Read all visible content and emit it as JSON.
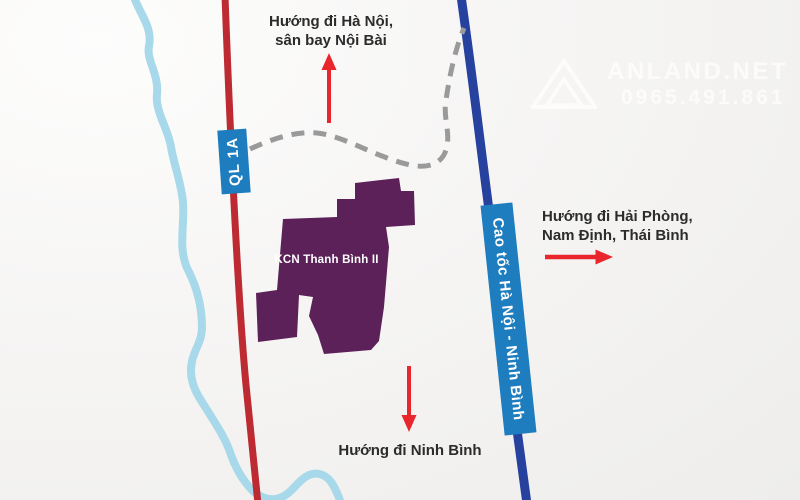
{
  "map": {
    "direction_labels": {
      "north": {
        "line1": "Hướng đi Hà Nội,",
        "line2": "sân bay Nội Bài"
      },
      "east": {
        "line1": "Hướng đi Hải Phòng,",
        "line2": "Nam Định, Thái Bình"
      },
      "south": {
        "line1": "Hướng đi Ninh Bình"
      }
    },
    "road_labels": {
      "national_road": "QL 1A",
      "expressway": "Cao tốc Hà Nội - Ninh Bình"
    },
    "industrial_zone": {
      "name": "KCN Thanh Bình II"
    },
    "watermark": {
      "brand": "ANLAND.NET",
      "phone": "0965.491.861"
    },
    "colors": {
      "river": "#a7d9ea",
      "national_road": "#bd2a31",
      "expressway": "#27419e",
      "road_label_bg": "#1e7dbf",
      "industrial_zone": "#5b2158",
      "connector_road": "#9a9a9a",
      "arrow": "#e8262b",
      "direction_text": "#2c2c2c",
      "watermark_text": "#fdfcfb"
    }
  }
}
